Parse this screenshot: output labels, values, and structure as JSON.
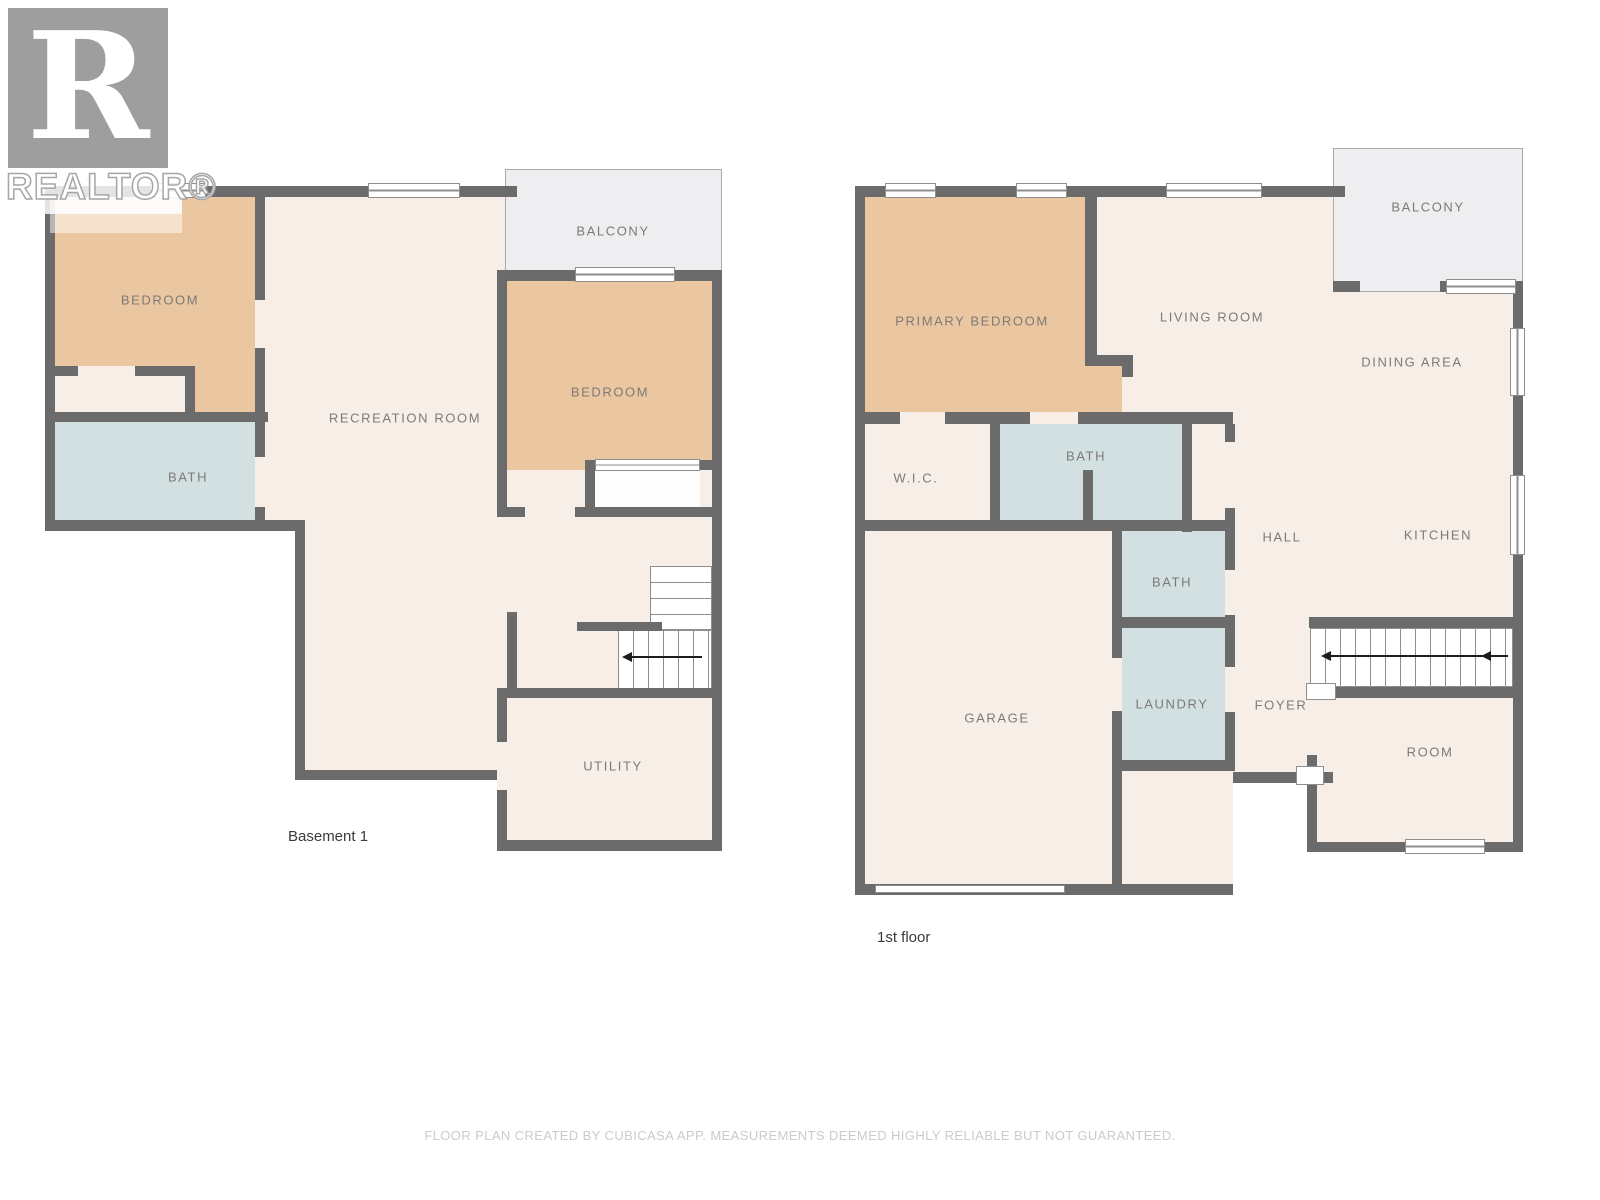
{
  "colors": {
    "wall": "#6b6b6b",
    "floor": "#f7eee7",
    "bedroom": "#eac7a1",
    "bath": "#d2e0e1",
    "balcony": "#eeeef0",
    "label": "#7d7a76",
    "caption": "#3a3a3a",
    "disclaimer": "#cbcbcb",
    "logo": "#9e9e9e",
    "stair_line": "#8e8e8e",
    "arrow": "#1d1d1d"
  },
  "logo": {
    "letter": "R",
    "brand": "REALTOR®"
  },
  "plans": [
    {
      "caption": "Basement 1",
      "rooms": [
        {
          "key": "bedroom-1",
          "label": "BEDROOM"
        },
        {
          "key": "balcony",
          "label": "BALCONY"
        },
        {
          "key": "bedroom-2",
          "label": "BEDROOM"
        },
        {
          "key": "recreation-room",
          "label": "RECREATION ROOM"
        },
        {
          "key": "bath",
          "label": "BATH"
        },
        {
          "key": "utility",
          "label": "UTILITY"
        }
      ]
    },
    {
      "caption": "1st floor",
      "rooms": [
        {
          "key": "primary-bedroom",
          "label": "PRIMARY BEDROOM"
        },
        {
          "key": "living-room",
          "label": "LIVING ROOM"
        },
        {
          "key": "balcony",
          "label": "BALCONY"
        },
        {
          "key": "dining-area",
          "label": "DINING AREA"
        },
        {
          "key": "wic",
          "label": "W.I.C."
        },
        {
          "key": "bath-upper",
          "label": "BATH"
        },
        {
          "key": "hall",
          "label": "HALL"
        },
        {
          "key": "kitchen",
          "label": "KITCHEN"
        },
        {
          "key": "bath-lower",
          "label": "BATH"
        },
        {
          "key": "laundry",
          "label": "LAUNDRY"
        },
        {
          "key": "foyer",
          "label": "FOYER"
        },
        {
          "key": "garage",
          "label": "GARAGE"
        },
        {
          "key": "room",
          "label": "ROOM"
        }
      ]
    }
  ],
  "footer": {
    "disclaimer": "FLOOR PLAN CREATED BY CUBICASA APP. MEASUREMENTS DEEMED HIGHLY RELIABLE BUT NOT GUARANTEED."
  }
}
